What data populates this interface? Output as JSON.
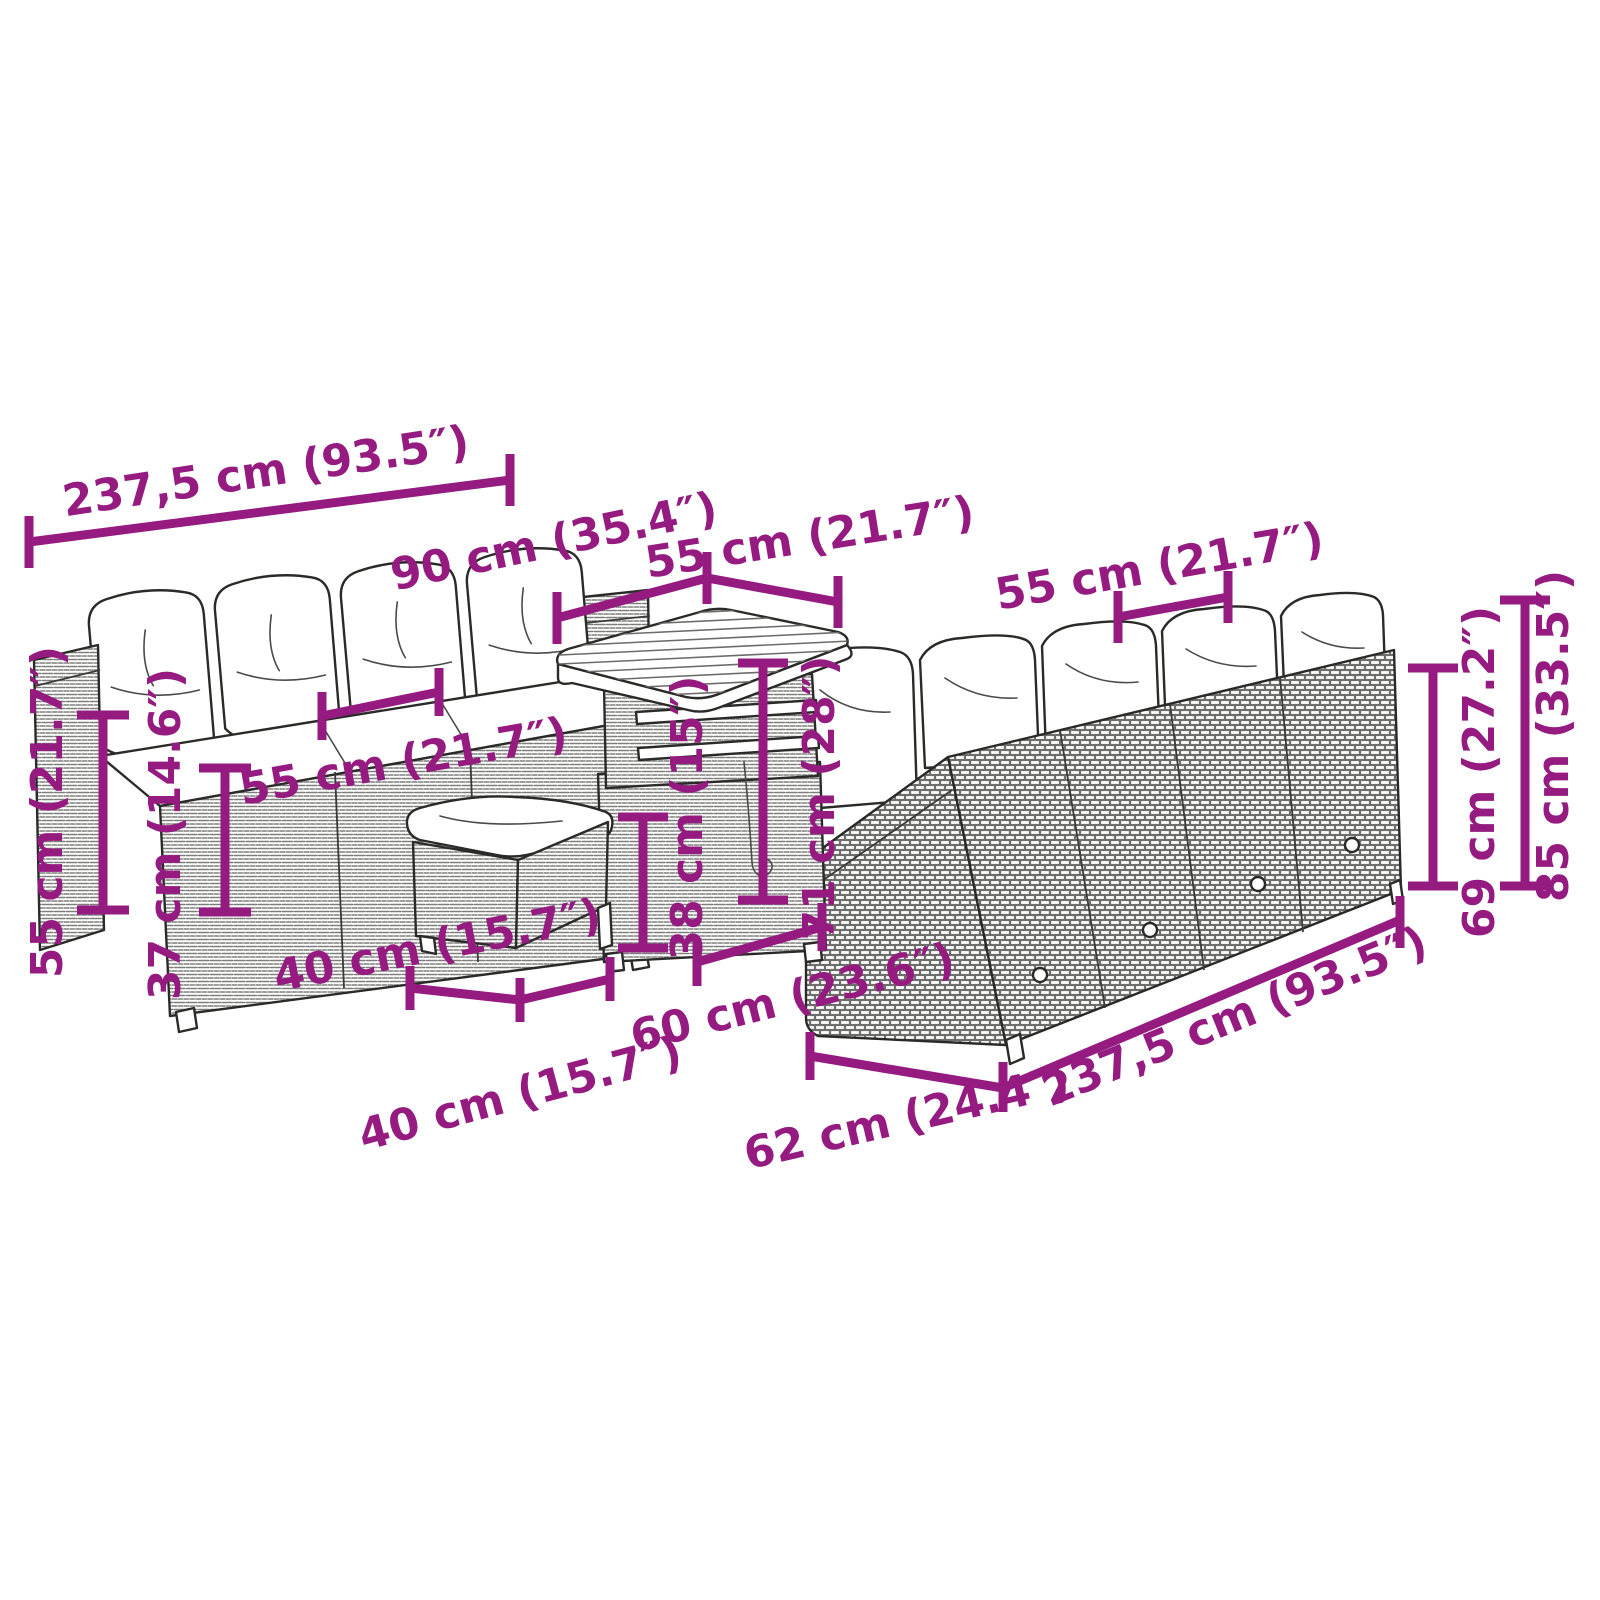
{
  "image": {
    "title": "Garden furniture set dimension diagram",
    "background": "#ffffff"
  },
  "colors": {
    "dimension": "#951B81",
    "line_art": "#2a2a28"
  },
  "dims": {
    "len_top": "237,5 cm (93.5″)",
    "depth_90": "90 cm (35.4″)",
    "table_top_55": "55 cm (21.7″)",
    "right_seat_55": "55 cm (21.7″)",
    "height_55": "55 cm (21.7″)",
    "seat_height_37": "37 cm (14.6″)",
    "left_seat_55": "55 cm (21.7″)",
    "stool_front_40": "40 cm (15.7″)",
    "stool_side_40": "40 cm (15.7″)",
    "table_60": "60 cm (23.6″)",
    "table_h38": "38 cm (15″)",
    "table_h71": "71 cm (28″)",
    "sofa_depth_62": "62 cm (24.4″)",
    "len_bottom": "237,5 cm (93.5″)",
    "back_h69": "69 cm (27.2″)",
    "total_h85": "85 cm (33.5″)"
  }
}
